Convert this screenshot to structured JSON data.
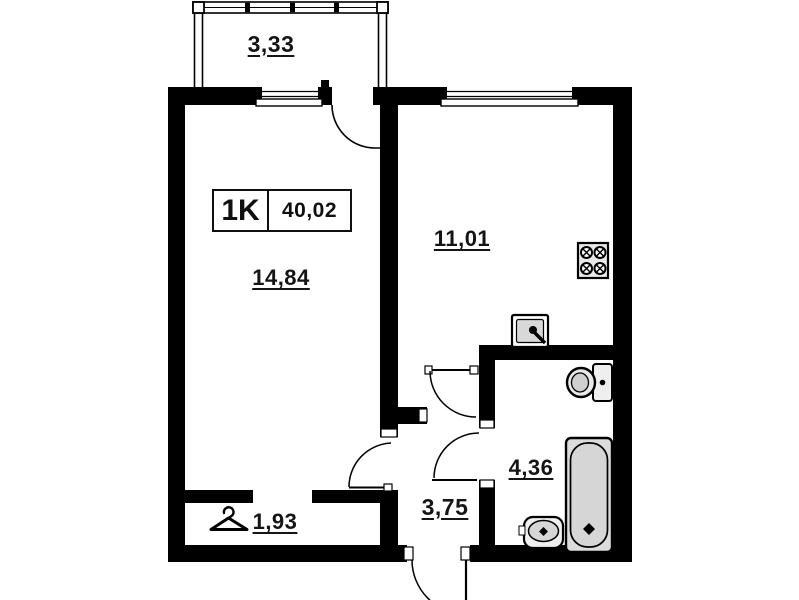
{
  "unit": {
    "type_label": "1K",
    "total_area": "40,02"
  },
  "rooms": {
    "balcony": "3,33",
    "living_room": "14,84",
    "kitchen": "11,01",
    "bathroom": "4,36",
    "hallway": "3,75",
    "closet": "1,93"
  },
  "icons": {
    "stove": "stove-icon",
    "kitchen_sink": "kitchen-sink-icon",
    "toilet": "toilet-icon",
    "bathtub": "bathtub-icon",
    "washbasin": "washbasin-icon",
    "hanger": "hanger-icon"
  },
  "colors": {
    "walls": "#000000",
    "background": "#ffffff",
    "fixture_fill": "#dcdcdc",
    "text": "#151515"
  }
}
